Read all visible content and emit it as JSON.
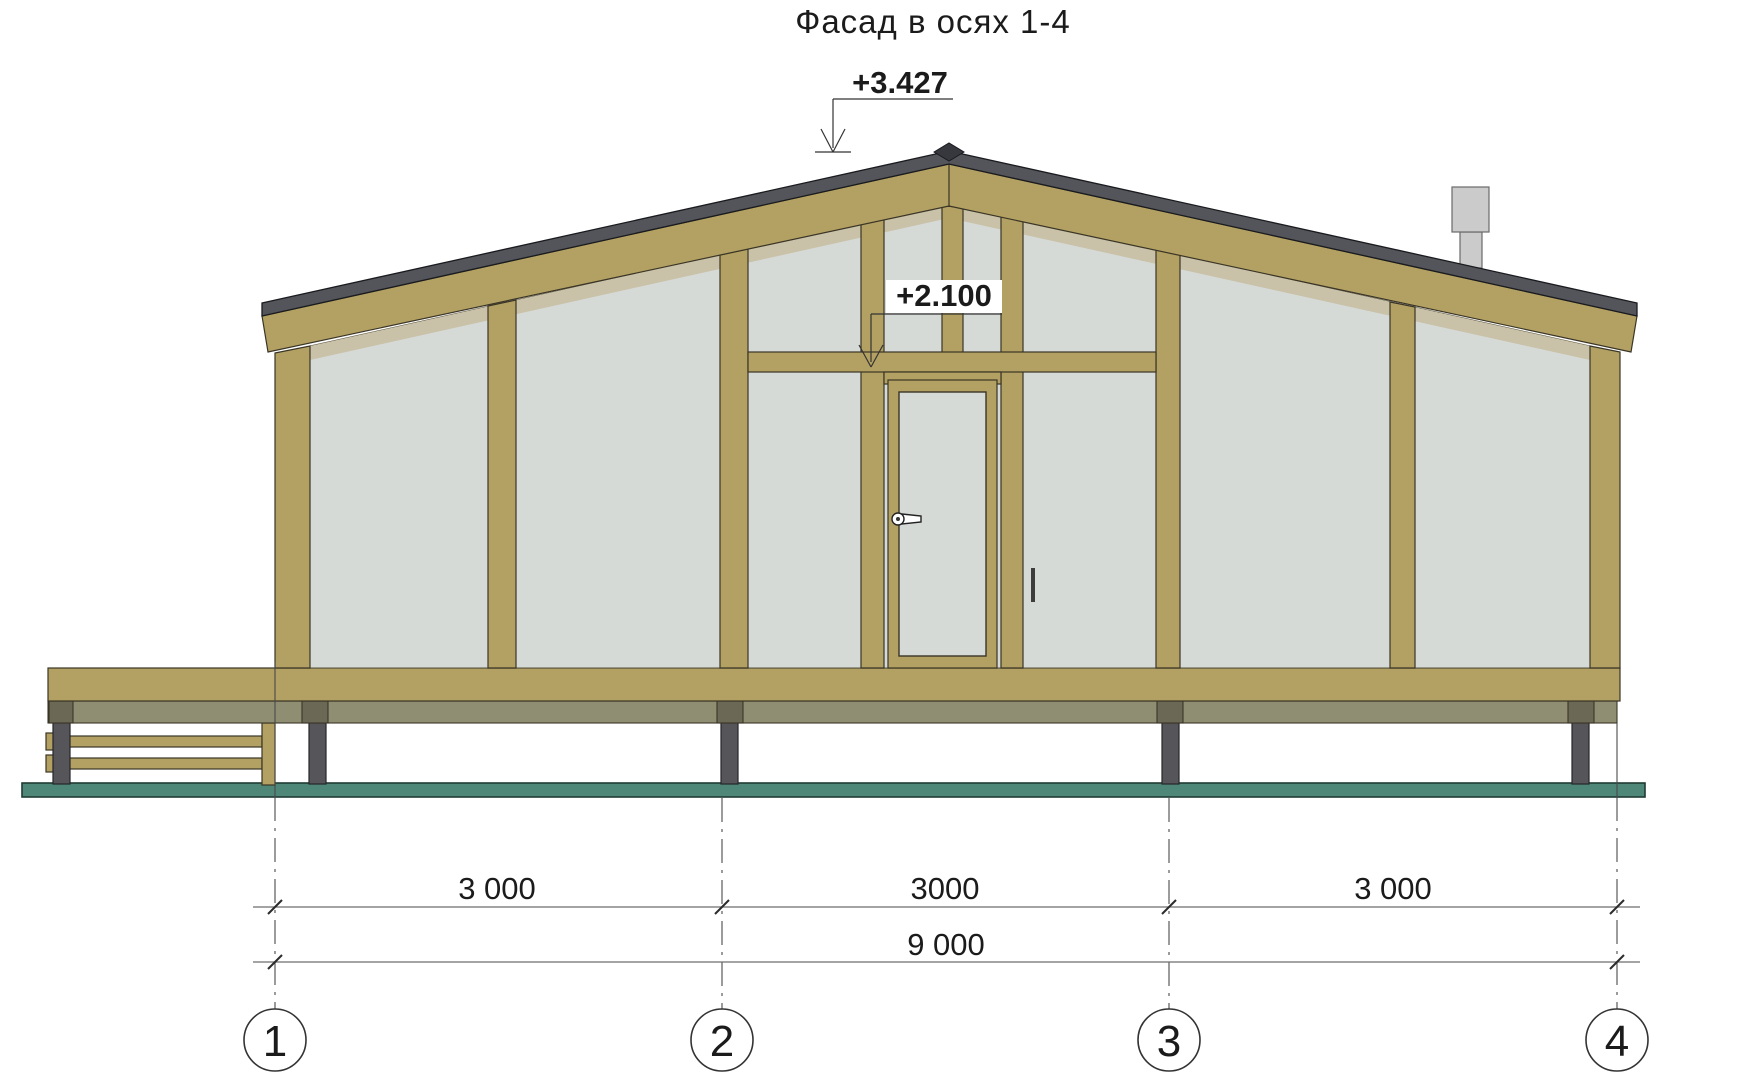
{
  "drawing": {
    "title": "Фасад в осях 1-4",
    "elevation_marks": {
      "ridge": {
        "label": "+3.427"
      },
      "door": {
        "label": "+2.100"
      }
    },
    "dimensions": {
      "segments": [
        "3 000",
        "3000",
        "3 000"
      ],
      "total": "9 000"
    },
    "axes": [
      {
        "label": "1"
      },
      {
        "label": "2"
      },
      {
        "label": "3"
      },
      {
        "label": "4"
      }
    ],
    "colors": {
      "paper": "#ffffff",
      "wood": "#b3a163",
      "wood_outline": "#3a3526",
      "glass": "#d6dad6",
      "glass_outline": "#55503c",
      "glass_shadow": "#c9c1a8",
      "roof": "#54555a",
      "roof_outline": "#1a1b1f",
      "roof_peak": "#37383d",
      "band": "#908e72",
      "pile_cap": "#6b6956",
      "pile": "#56565a",
      "pile_outline": "#26262a",
      "ground": "#4e8678",
      "ground_outline": "#1f3b33",
      "chimney": "#cbcbcb",
      "chimney_outline": "#6a6a6a",
      "dim": "#6e6e6e",
      "ann": "#333333",
      "ink": "#1b1b1b"
    }
  }
}
